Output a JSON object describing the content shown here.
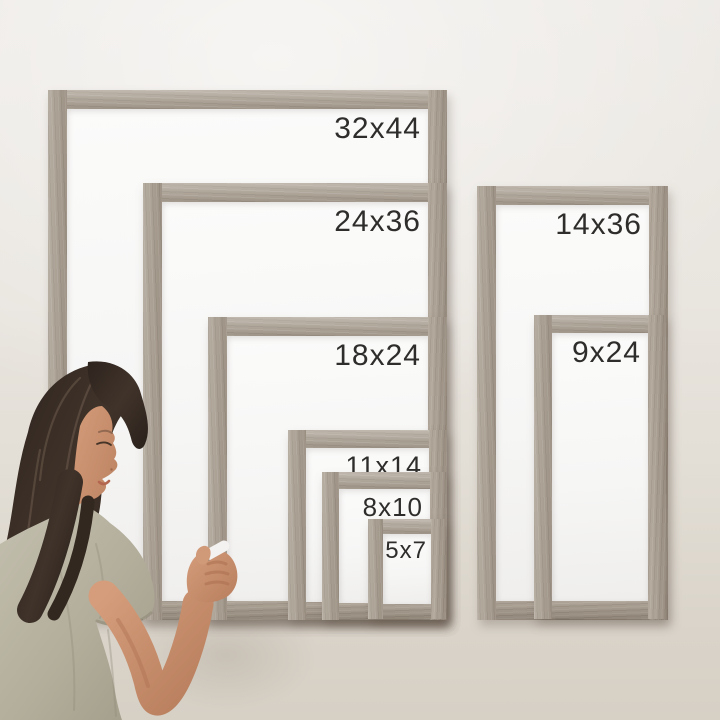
{
  "frames": {
    "left_group": [
      {
        "label": "32x44"
      },
      {
        "label": "24x36"
      },
      {
        "label": "18x24"
      },
      {
        "label": "11x14"
      },
      {
        "label": "8x10"
      },
      {
        "label": "5x7"
      }
    ],
    "right_group": [
      {
        "label": "14x36"
      },
      {
        "label": "9x24"
      }
    ]
  },
  "colors": {
    "wall": "#e8e4de",
    "wood": "#a89d8f",
    "board": "#f8f7f6",
    "label-text": "#2e2d2b",
    "hair": "#382d26",
    "hair-highlight": "#8a7460",
    "skin": "#c78f6e",
    "skin-shadow": "#a96f50",
    "shirt": "#b7b3a0",
    "shirt-shadow": "#9d9a86",
    "marker-body": "#f3f2f0",
    "marker-band": "#766f68"
  }
}
